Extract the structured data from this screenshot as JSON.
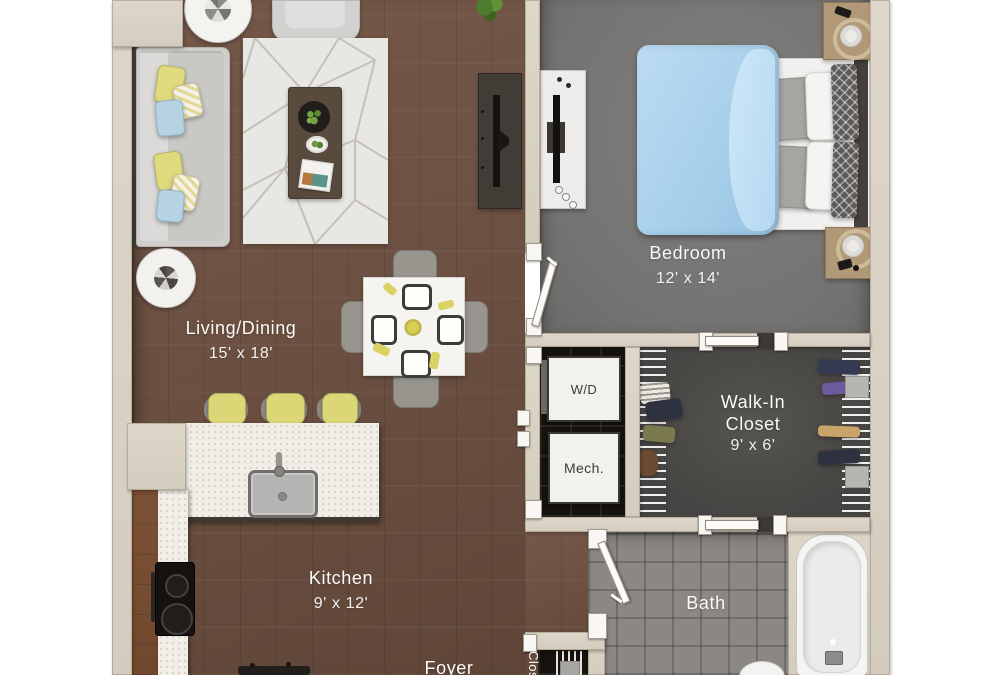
{
  "plan_type": "floor-plan",
  "rooms": {
    "living": {
      "name": "Living/Dining",
      "dims": "15' x 18'"
    },
    "bedroom": {
      "name": "Bedroom",
      "dims": "12' x 14'"
    },
    "walkin": {
      "line1": "Walk-In",
      "line2": "Closet",
      "dims": "9' x 6'"
    },
    "kitchen": {
      "name": "Kitchen",
      "dims": "9' x 12'"
    },
    "bath": {
      "name": "Bath"
    },
    "foyer": {
      "name": "Foyer"
    },
    "laundry": {
      "name": "W/D"
    },
    "mech": {
      "name": "Mech."
    },
    "entry_closet": {
      "name": "Closet"
    }
  },
  "palette": {
    "background": "#ffffff",
    "wall": "#d9d2c4",
    "wood_floor": "#6d5243",
    "bedroom_carpet": "#7a7876",
    "walkin_floor": "#4f4d4b",
    "utility_floor": "#17140f",
    "bath_tile": "#8b8783",
    "counter": "#f0eee6",
    "rug": "#e9e7e4",
    "accent_yellow": "#ddd876",
    "accent_blue": "#a9d3ec"
  }
}
